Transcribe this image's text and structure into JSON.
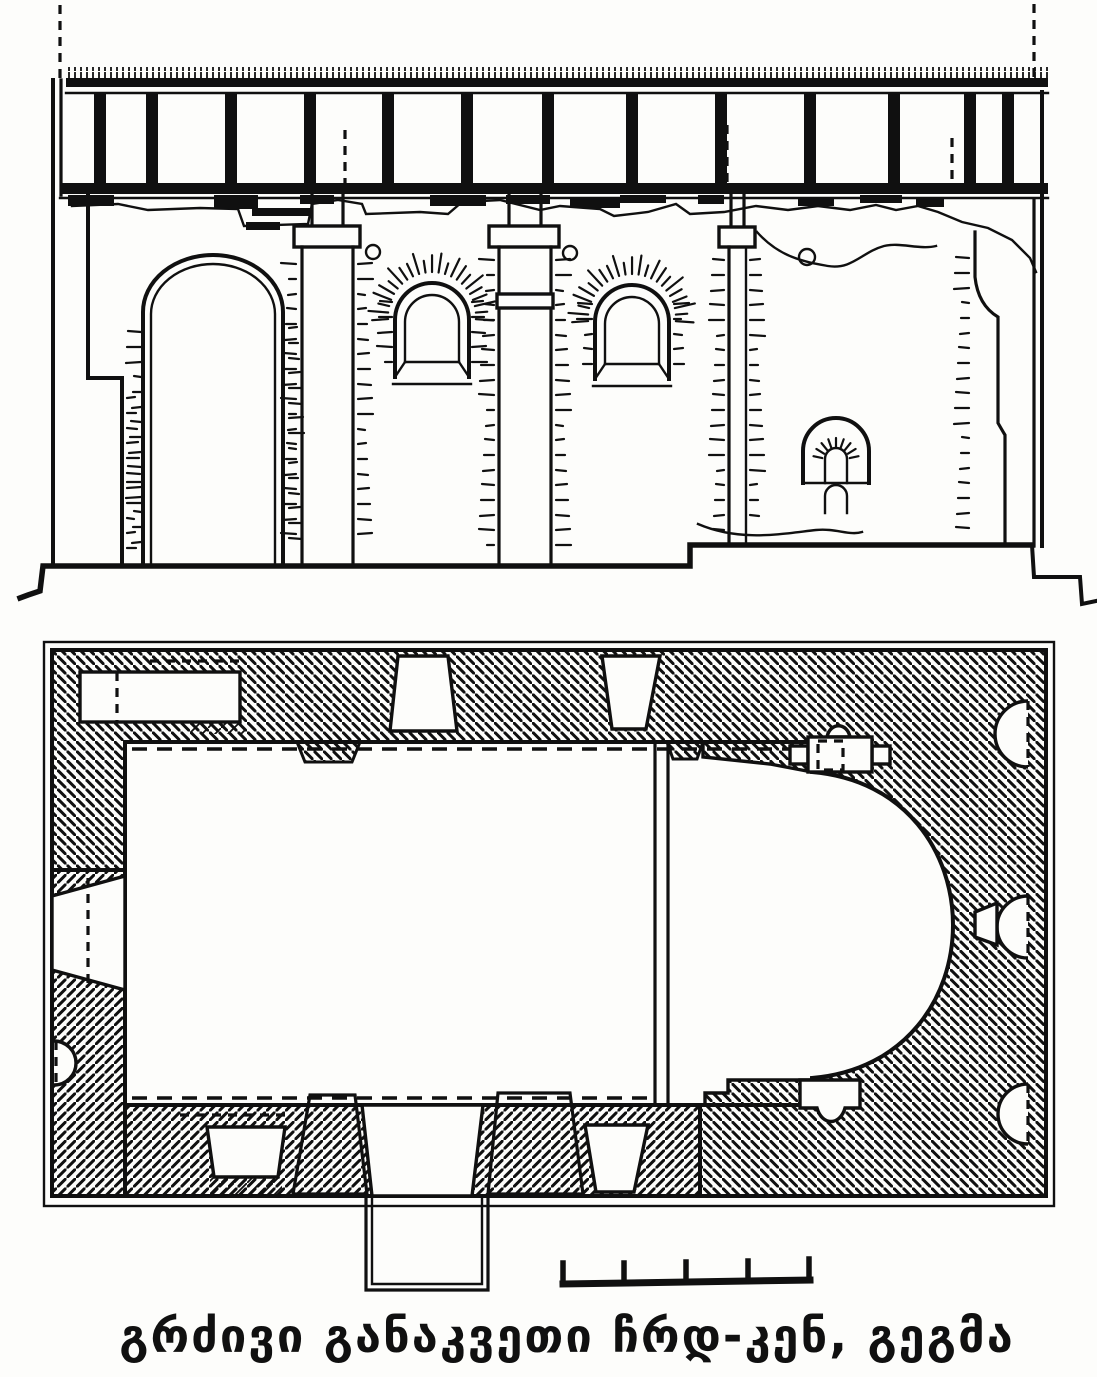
{
  "page": {
    "paper": "#fdfdfb",
    "ink": "#101010"
  },
  "caption": {
    "text": "გრძივი განაკვეთი ჩრდ-კენ, გეგმა"
  },
  "figure": {
    "kind": "measured architectural drawing of a single-nave church",
    "views": [
      {
        "name": "longitudinal-section",
        "features": [
          "flat timber roof on posts",
          "west arch",
          "two arched windows with radiating voussoirs",
          "pilasters with capitals",
          "double-arched niche",
          "putlog holes",
          "ruined wall contour"
        ]
      },
      {
        "name": "floor-plan",
        "features": [
          "hatched masonry walls",
          "horseshoe apse at east",
          "three semicircular niches in east wall",
          "splayed windows and doors",
          "wall niche at north-west",
          "south porch annex",
          "chancel line",
          "dashed vault lines"
        ]
      }
    ],
    "scale_bar": {
      "divisions": 4
    }
  }
}
